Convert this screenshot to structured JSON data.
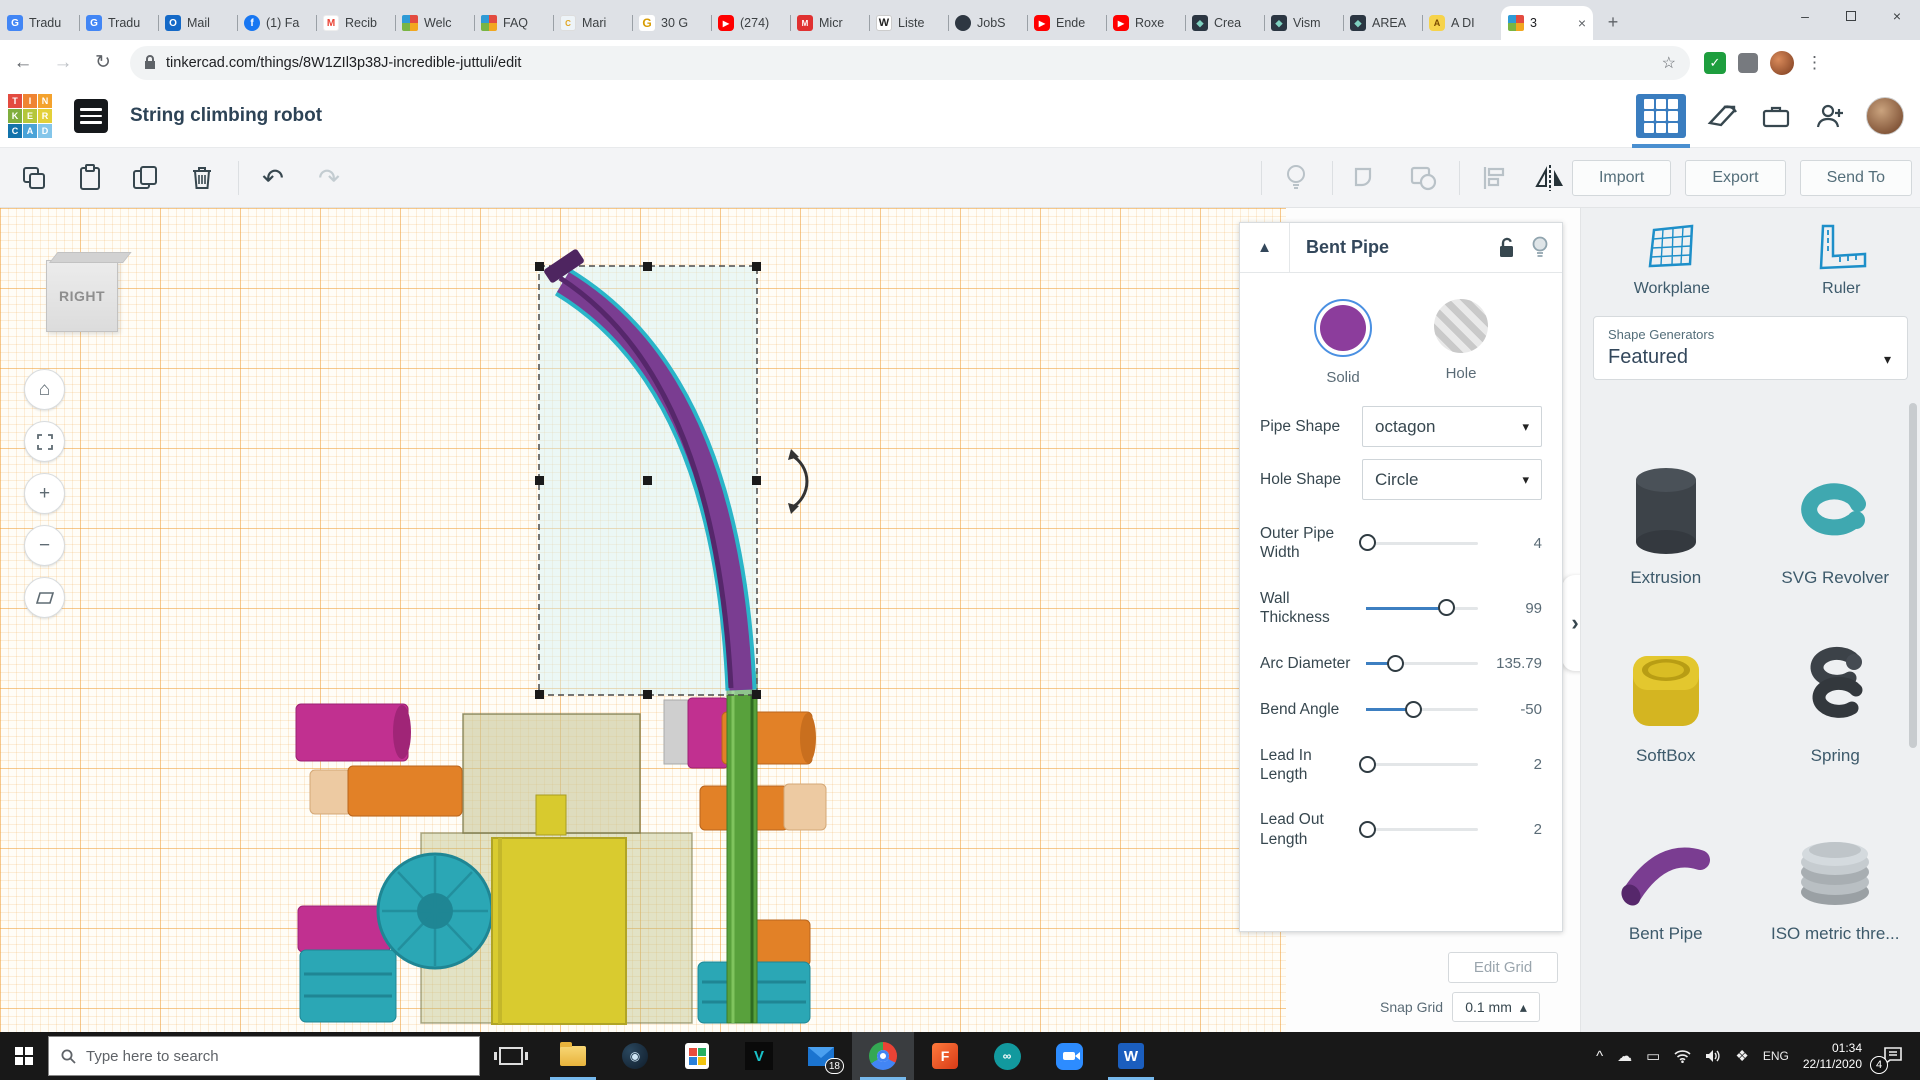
{
  "browser": {
    "tabs": [
      {
        "label": "Tradu",
        "icon": "translate"
      },
      {
        "label": "Tradu",
        "icon": "translate"
      },
      {
        "label": "Mail",
        "icon": "outlook"
      },
      {
        "label": "(1) Fa",
        "icon": "facebook"
      },
      {
        "label": "Recib",
        "icon": "gmail"
      },
      {
        "label": "Welc",
        "icon": "tinkercad"
      },
      {
        "label": "FAQ",
        "icon": "tinkercad"
      },
      {
        "label": "Mari",
        "icon": "columbia"
      },
      {
        "label": "30 G",
        "icon": "gold-g"
      },
      {
        "label": "(274)",
        "icon": "youtube"
      },
      {
        "label": "Micr",
        "icon": "red-app"
      },
      {
        "label": "Liste",
        "icon": "wikipedia"
      },
      {
        "label": "JobS",
        "icon": "globe"
      },
      {
        "label": "Ende",
        "icon": "youtube"
      },
      {
        "label": "Roxe",
        "icon": "youtube"
      },
      {
        "label": "Crea",
        "icon": "dark-app"
      },
      {
        "label": "Vism",
        "icon": "dark-app"
      },
      {
        "label": "AREA",
        "icon": "dark-app"
      },
      {
        "label": "A DI",
        "icon": "robot"
      },
      {
        "label": "3",
        "icon": "tinkercad",
        "active": true
      }
    ],
    "url": "tinkercad.com/things/8W1ZIl3p38J-incredible-juttuli/edit"
  },
  "icons": {
    "back": "←",
    "forward": "→",
    "reload": "↻",
    "star": "☆",
    "menu": "⋮",
    "close": "×",
    "minimize": "–",
    "new_tab": "+",
    "tab_close": "×",
    "chevron_right": "›",
    "collapse": "▲",
    "caret_down": "▾",
    "caret_up": "▴",
    "check": "✓",
    "home": "⌂",
    "plus": "+",
    "minus": "−",
    "undo": "↶",
    "redo": "↷",
    "tray_up": "^",
    "cloud": "☁",
    "screen": "▭",
    "dropbox": "❖",
    "steam": "◉",
    "arduino": "∞",
    "predator": "V",
    "word": "W",
    "fusion": "F",
    "search": "⌕"
  },
  "header": {
    "title": "String climbing robot",
    "import_label": "Import",
    "export_label": "Export",
    "send_to_label": "Send To"
  },
  "viewport": {
    "view_label": "RIGHT",
    "edit_grid_label": "Edit Grid",
    "snap_grid_label": "Snap Grid",
    "snap_grid_value": "0.1 mm"
  },
  "inspector": {
    "title": "Bent Pipe",
    "solid_label": "Solid",
    "hole_label": "Hole",
    "pipe_shape_label": "Pipe Shape",
    "pipe_shape_value": "octagon",
    "hole_shape_label": "Hole Shape",
    "hole_shape_value": "Circle",
    "sliders": [
      {
        "label": "Outer Pipe Width",
        "value": "4",
        "fill": 2
      },
      {
        "label": "Wall Thickness",
        "value": "99",
        "fill": 72
      },
      {
        "label": "Arc Diameter",
        "value": "135.79",
        "fill": 27
      },
      {
        "label": "Bend Angle",
        "value": "-50",
        "fill": 43
      },
      {
        "label": "Lead In Length",
        "value": "2",
        "fill": 2
      },
      {
        "label": "Lead Out Length",
        "value": "2",
        "fill": 2
      }
    ]
  },
  "shapes_panel": {
    "workplane_label": "Workplane",
    "ruler_label": "Ruler",
    "generators_label": "Shape Generators",
    "generators_value": "Featured",
    "items": [
      "Extrusion",
      "SVG Revolver",
      "SoftBox",
      "Spring",
      "Bent Pipe",
      "ISO metric thre..."
    ]
  },
  "taskbar": {
    "search_placeholder": "Type here to search",
    "language": "ENG",
    "time": "01:34",
    "date": "22/11/2020",
    "mail_badge": "18",
    "notification_count": "4"
  }
}
